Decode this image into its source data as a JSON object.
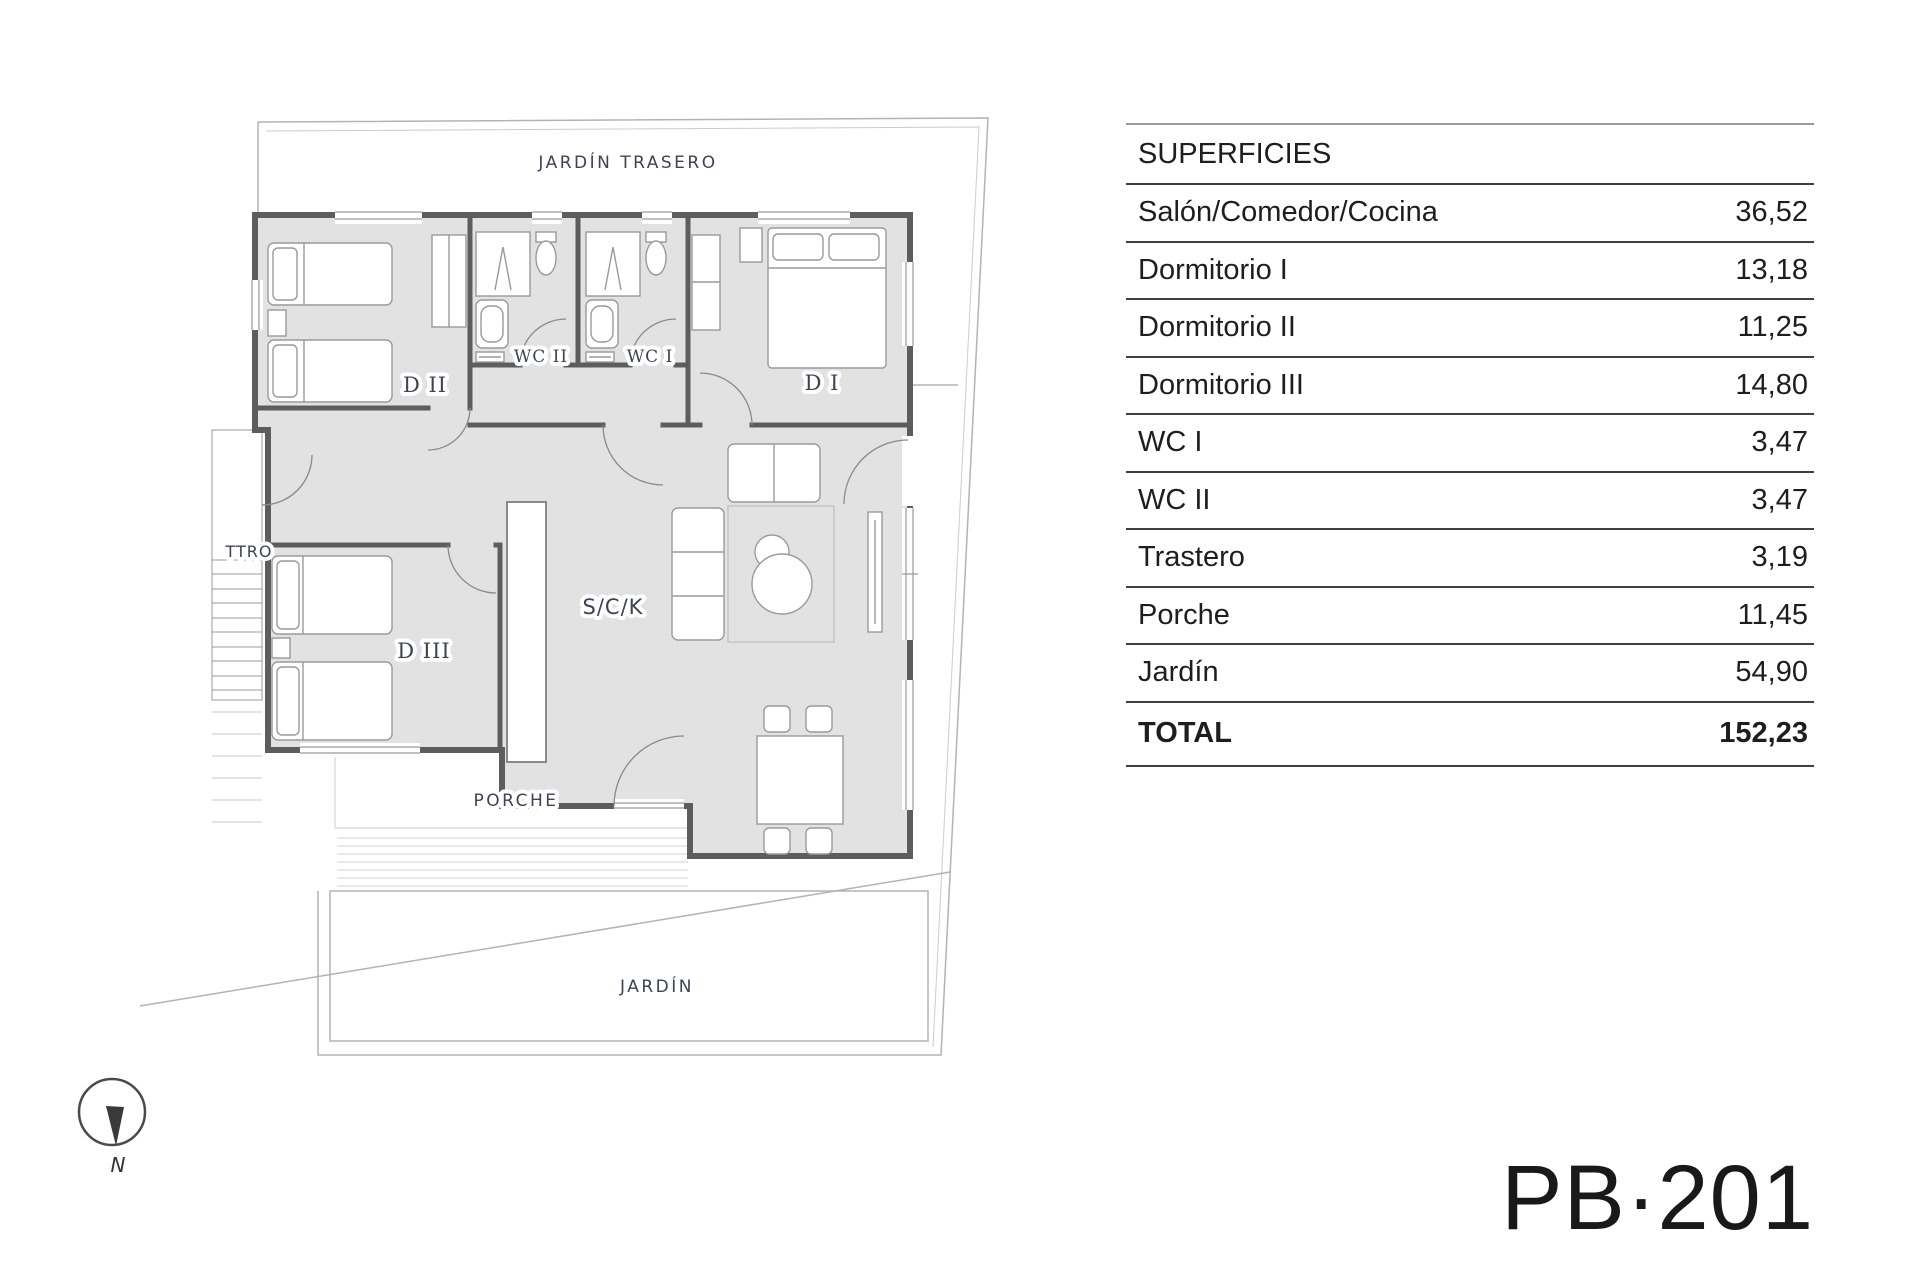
{
  "plan": {
    "labels": {
      "garden_back": "JARDÍN TRASERO",
      "d2": "D II",
      "wc2": "WC II",
      "wc1": "WC I",
      "d1": "D I",
      "ttro": "TTRO",
      "d3": "D III",
      "sck": "S/C/K",
      "porch": "PORCHE",
      "garden": "JARDÍN"
    },
    "compass": {
      "label": "N"
    }
  },
  "table": {
    "header": "SUPERFICIES",
    "rows": [
      {
        "label": "Salón/Comedor/Cocina",
        "value": "36,52"
      },
      {
        "label": "Dormitorio I",
        "value": "13,18"
      },
      {
        "label": "Dormitorio II",
        "value": "11,25"
      },
      {
        "label": "Dormitorio III",
        "value": "14,80"
      },
      {
        "label": "WC I",
        "value": "3,47"
      },
      {
        "label": "WC II",
        "value": "3,47"
      },
      {
        "label": "Trastero",
        "value": "3,19"
      },
      {
        "label": "Porche",
        "value": "11,45"
      },
      {
        "label": "Jardín",
        "value": "54,90"
      }
    ],
    "total": {
      "label": "TOTAL",
      "value": "152,23"
    }
  },
  "plan_code": "PB·201",
  "colors": {
    "label_blue": "#3c4454",
    "wall_gray": "#5d5d5d",
    "room_fill": "#e2e2e2",
    "boundary_gray": "#b3b3b3",
    "table_line": "#3f3f3f"
  }
}
